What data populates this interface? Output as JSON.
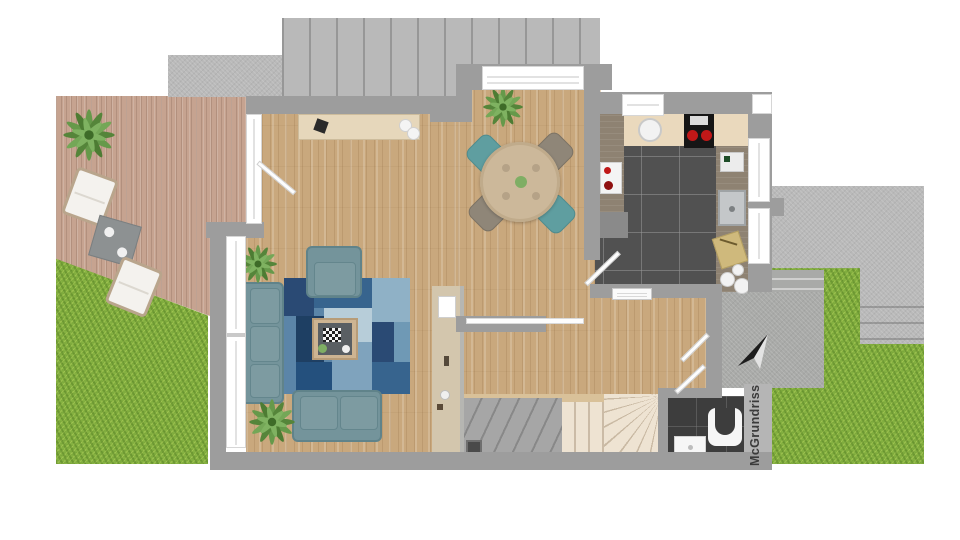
{
  "watermark": {
    "text": "McGrundriss"
  },
  "scene": {
    "type": "3d-floor-plan-top-view",
    "outdoor": {
      "areas": [
        "garden-left",
        "garden-right",
        "wood-terrace-deck",
        "concrete-driveway",
        "concrete-patio-right",
        "entry-porch",
        "exterior-steps"
      ],
      "deck_furniture": [
        "lounge-chair",
        "side-table",
        "lounge-chair"
      ],
      "north_arrow": true
    },
    "rooms": [
      {
        "name": "living-area",
        "floor": "oak-parquet",
        "furniture": [
          "three-seat-sofa",
          "armchair",
          "loveseat",
          "patchwork-rug",
          "coffee-table",
          "sideboard",
          "potted-plant",
          "potted-plant"
        ]
      },
      {
        "name": "dining-area",
        "floor": "oak-parquet",
        "furniture": [
          "round-dining-table",
          "chair-teal",
          "chair-taupe",
          "chair-taupe",
          "chair-teal",
          "potted-plant"
        ]
      },
      {
        "name": "kitchen",
        "floor": "dark-gray-tile",
        "furniture": [
          "counter-run",
          "cooktop-two-burners",
          "round-basin",
          "rect-sink",
          "cutting-board",
          "plates",
          "coffee-machine",
          "base-cabinet"
        ]
      },
      {
        "name": "hallway",
        "floor": "oak-parquet",
        "furniture": [
          "radiator",
          "coat-rack-wall"
        ]
      },
      {
        "name": "staircase",
        "floor": "carpet-and-wood-steps",
        "furniture": [
          "winder-stairs",
          "gray-landing"
        ]
      },
      {
        "name": "bathroom",
        "floor": "black-tile",
        "furniture": [
          "wall-hung-toilet",
          "washbasin"
        ]
      }
    ],
    "openings": [
      "deck-door-open",
      "kitchen-door-open",
      "front-door-open",
      "bathroom-door-open",
      "sliding-door-living-hall",
      "bay-window",
      "kitchen-window",
      "kitchen-side-windows",
      "living-side-windows"
    ]
  },
  "colors": {
    "grass": "#85b141",
    "deck_wood": "#c6a390",
    "floor_wood": "#c9a87d",
    "wall_gray": "#9d9d9d",
    "concrete": "#b9b9b9",
    "kitchen_tile": "#515151",
    "bath_tile": "#3d3d3d",
    "sofa_teal": "#74949b",
    "chair_teal": "#5f9ea0",
    "chair_taupe": "#8f8678",
    "rug_navy": "#1e3f63",
    "rug_mid_blue": "#37648e",
    "rug_light_blue": "#8fb1c6",
    "counter_beige": "#ead9bd",
    "stair_cream": "#eee3d2",
    "watermark_text": "#3b3b3b"
  }
}
